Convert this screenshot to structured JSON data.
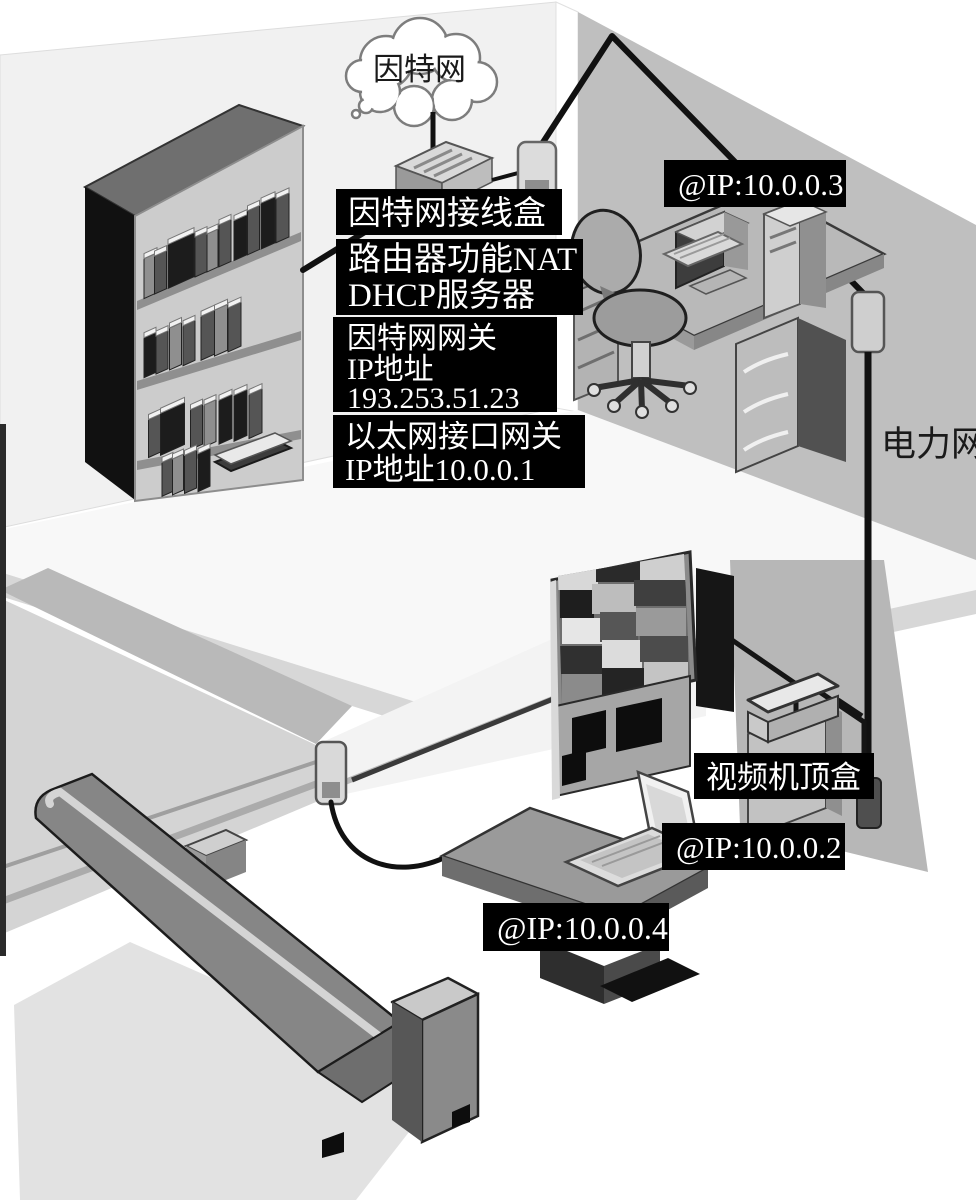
{
  "scene": {
    "cloud_label": "因特网",
    "power_network_label": "电力网",
    "boxes": {
      "junction": "因特网接线盒",
      "router_line1": "路由器功能NAT",
      "router_line2": "DHCP服务器",
      "gateway_line1": "因特网网关",
      "gateway_line2": "IP地址",
      "gateway_line3": "193.253.51.23",
      "ethernet_line1": "以太网接口网关",
      "ethernet_line2": "IP地址10.0.0.1",
      "set_top": "视频机顶盒",
      "ip_desktop": "@IP:10.0.0.3",
      "ip_settop": "@IP:10.0.0.2",
      "ip_laptop": "@IP:10.0.0.4"
    },
    "colors": {
      "label_bg": "#000000",
      "label_text": "#ffffff",
      "wire": "#111111",
      "wall_gray": "#bfbfbf"
    }
  }
}
